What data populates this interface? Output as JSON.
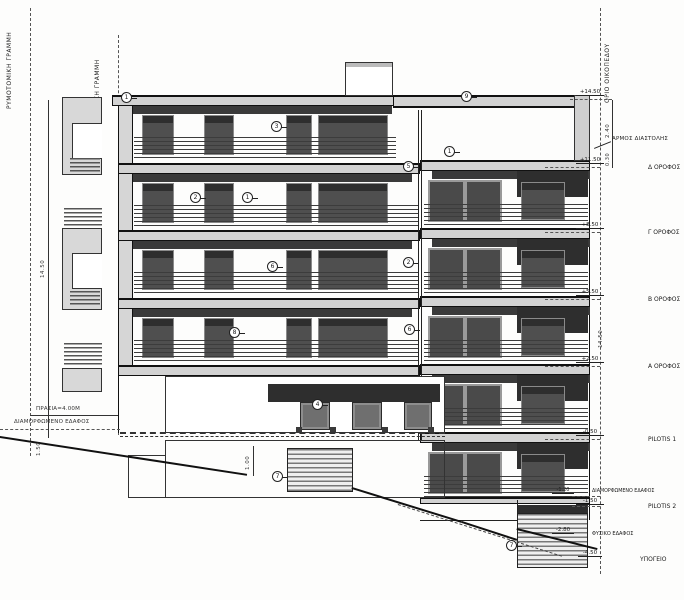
{
  "paper": {
    "bg": "#fdfdfc",
    "ink": "#1a1a1a"
  },
  "colors": {
    "slab": "#d2d2d2",
    "shadow": "#3a3a3a",
    "window": "#4f4f4f",
    "window_frame": "#8f8f8f",
    "dark_band": "#2e2e2e"
  },
  "boundaries": {
    "street_line": "ΡΥΜΟΤΟΜΙΚΗ ΓΡΑΜΜΗ",
    "building_line": "ΟΙΚΟΔΟΜΙΚΗ ΓΡΑΜΜΗ",
    "plot_boundary": "ΟΡΙΟ ΟΙΚΟΠΕΔΟΥ"
  },
  "levels": [
    {
      "label": "",
      "elevation": "+14.50"
    },
    {
      "label": "Δ ΟΡΟΦΟΣ",
      "elevation": "+11.50"
    },
    {
      "label": "Γ ΟΡΟΦΟΣ",
      "elevation": "+8.50"
    },
    {
      "label": "Β ΟΡΟΦΟΣ",
      "elevation": "+5.50"
    },
    {
      "label": "Α ΟΡΟΦΟΣ",
      "elevation": "+2.50"
    },
    {
      "label": "PILOTIS 1",
      "elevation": "-0.50"
    },
    {
      "label": "ΔΙΑΜΟΡΦΩΜΕΝΟ ΕΔΑΦΟΣ",
      "elevation": "-1.20"
    },
    {
      "label": "PILOTIS 2",
      "elevation": "-1.50"
    },
    {
      "label": "ΦΥΣΙΚΟ ΕΔΑΦΟΣ",
      "elevation": "-2.80"
    },
    {
      "label": "ΥΠΟΓΕΙΟ",
      "elevation": "-4.50"
    }
  ],
  "notes": {
    "expansion_joint": "ΑΡΜΟΣ ΔΙΑΣΤΟΛΗΣ",
    "front_garden_dim": "ΠΡΑΣΙΑ=4.00Μ",
    "formed_ground": "ΔΙΑΜΟΡΦΩΜΕΝΟ ΕΔΑΦΟΣ"
  },
  "dimensions": {
    "height_left": "14.50",
    "height_right": "14.50",
    "parapet": "2.40",
    "joint": "0.30",
    "ground_left": "1.50",
    "pilotis_step": "1.00"
  },
  "callouts": [
    {
      "n": "1"
    },
    {
      "n": "3"
    },
    {
      "n": "9"
    },
    {
      "n": "1"
    },
    {
      "n": "5"
    },
    {
      "n": "2"
    },
    {
      "n": "1"
    },
    {
      "n": "6"
    },
    {
      "n": "2"
    },
    {
      "n": "8"
    },
    {
      "n": "6"
    },
    {
      "n": "4"
    },
    {
      "n": "7"
    },
    {
      "n": "7"
    }
  ]
}
